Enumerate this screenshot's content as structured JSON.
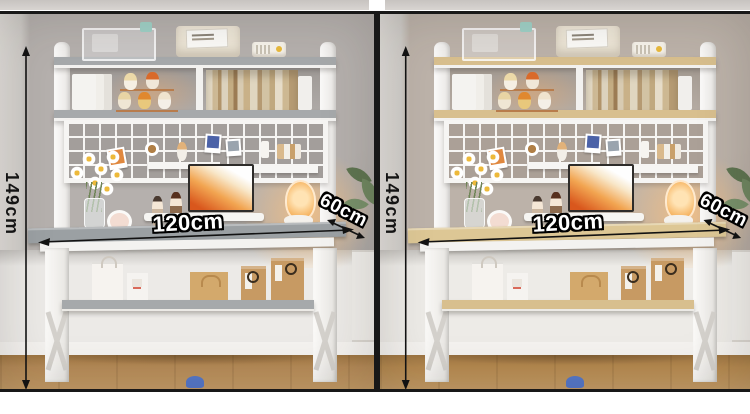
{
  "page": {
    "description": "Two-colorway product photos of a computer desk with hutch bookshelf, annotated with dimensions",
    "background": "#ffffff",
    "frame_color": "#181818"
  },
  "panels": [
    {
      "name": "grey-colorway-photo",
      "labels": {
        "height": "149cm",
        "width": "120cm",
        "depth": "60cm"
      },
      "colors": {
        "wall": "#b5b0ad",
        "wall_deep": "#a39e9b",
        "board": "#a6a9ab",
        "desk": "#9ba0a3",
        "under_wall": "#eceae7",
        "floor": "#b58a57",
        "glow_c": "#ffc37e"
      }
    },
    {
      "name": "oak-colorway-photo",
      "labels": {
        "height": "149cm",
        "width": "120cm",
        "depth": "60cm"
      },
      "colors": {
        "wall": "#bcb2a9",
        "wall_deep": "#aba097",
        "board": "#d8bf8e",
        "desk": "#ddc795",
        "under_wall": "#edebe7",
        "floor": "#b5894f",
        "glow_c": "#ffc37e"
      }
    }
  ]
}
